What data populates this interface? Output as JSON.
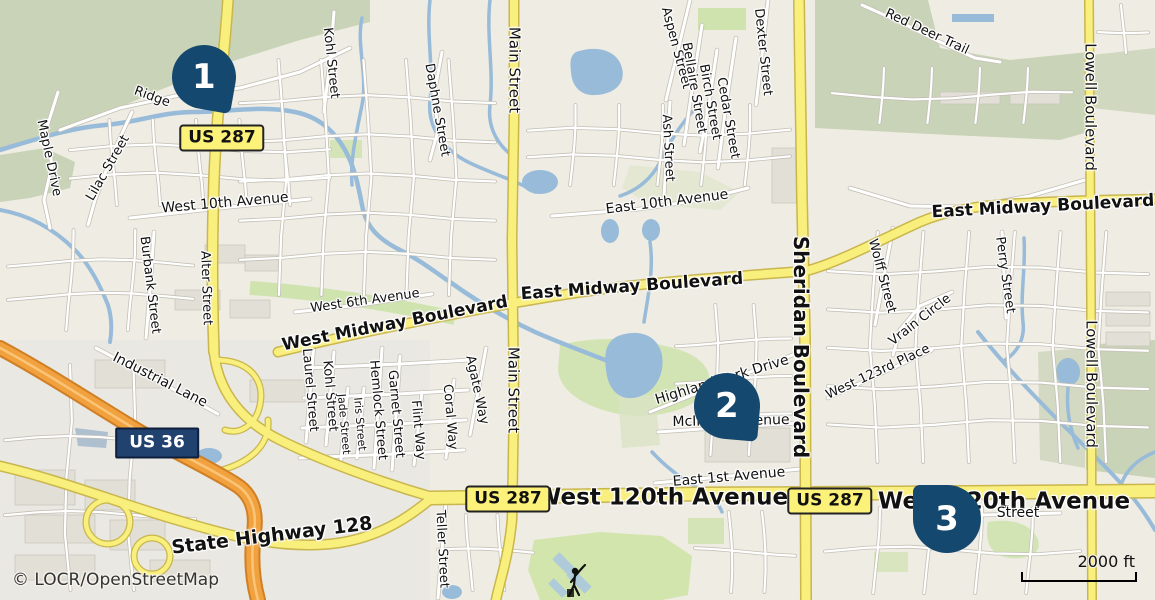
{
  "map": {
    "attribution": "© LOCR/OpenStreetMap",
    "scale": {
      "label": "2000 ft"
    }
  },
  "colors": {
    "land": "#efece3",
    "scrub_green": "#c9d3b7",
    "park_green": "#cfe3ae",
    "water": "#97bbd9",
    "road_major_fill": "#f9ef7d",
    "road_major_casing": "#c9b64d",
    "motorway_fill": "#f2a13f",
    "motorway_casing": "#cf7f24",
    "marker": "#15486e",
    "shield_yellow_bg": "#fdf279",
    "shield_navy_bg": "#21416f"
  },
  "markers": [
    {
      "number": "1",
      "x": 204,
      "y": 77,
      "size": 64,
      "tail": "br",
      "rot": 10
    },
    {
      "number": "2",
      "x": 727,
      "y": 406,
      "size": 66,
      "tail": "br",
      "rot": 5
    },
    {
      "number": "3",
      "x": 947,
      "y": 519,
      "size": 68,
      "tail": "tl",
      "rot": 0
    }
  ],
  "shields": [
    {
      "id": "us287-north",
      "label": "US 287",
      "style": "yellow",
      "x": 222,
      "y": 138
    },
    {
      "id": "us36",
      "label": "US 36",
      "style": "navy",
      "x": 157,
      "y": 443
    },
    {
      "id": "us287-west",
      "label": "US 287",
      "style": "yellow",
      "x": 508,
      "y": 499
    },
    {
      "id": "us287-east",
      "label": "US 287",
      "style": "yellow",
      "x": 830,
      "y": 501
    }
  ],
  "labels": [
    {
      "text": "Ridge",
      "x": 152,
      "y": 97,
      "rot": 20,
      "size": 13,
      "bold": false
    },
    {
      "text": "Maple Drive",
      "x": 49,
      "y": 158,
      "rot": 78,
      "size": 13,
      "bold": false
    },
    {
      "text": "Lilac Street",
      "x": 108,
      "y": 168,
      "rot": -60,
      "size": 13,
      "bold": false
    },
    {
      "text": "Kohl Street",
      "x": 331,
      "y": 63,
      "rot": 84,
      "size": 13,
      "bold": false
    },
    {
      "text": "Daphne Street",
      "x": 437,
      "y": 110,
      "rot": 80,
      "size": 13,
      "bold": false
    },
    {
      "text": "Main Street",
      "x": 514,
      "y": 70,
      "rot": 90,
      "size": 15,
      "bold": false
    },
    {
      "text": "Aspen Street",
      "x": 676,
      "y": 48,
      "rot": 75,
      "size": 13,
      "bold": false
    },
    {
      "text": "Bellaire Street",
      "x": 694,
      "y": 88,
      "rot": 80,
      "size": 13,
      "bold": false
    },
    {
      "text": "Birch Street",
      "x": 710,
      "y": 102,
      "rot": 80,
      "size": 13,
      "bold": false
    },
    {
      "text": "Cedar Street",
      "x": 728,
      "y": 118,
      "rot": 80,
      "size": 13,
      "bold": false
    },
    {
      "text": "Dexter Street",
      "x": 763,
      "y": 52,
      "rot": 84,
      "size": 13,
      "bold": false
    },
    {
      "text": "Ash Street",
      "x": 668,
      "y": 148,
      "rot": 87,
      "size": 13,
      "bold": false
    },
    {
      "text": "Red Deer Trail",
      "x": 927,
      "y": 32,
      "rot": 25,
      "size": 13,
      "bold": false
    },
    {
      "text": "Lowell Boulevard",
      "x": 1090,
      "y": 107,
      "rot": 90,
      "size": 15,
      "bold": false
    },
    {
      "text": "West 10th Avenue",
      "x": 225,
      "y": 203,
      "rot": -5,
      "size": 14,
      "bold": false
    },
    {
      "text": "East 10th Avenue",
      "x": 667,
      "y": 202,
      "rot": -7,
      "size": 14,
      "bold": false
    },
    {
      "text": "East Midway Boulevard",
      "x": 1043,
      "y": 207,
      "rot": -3,
      "size": 17,
      "bold": true
    },
    {
      "text": "Perry Street",
      "x": 1005,
      "y": 275,
      "rot": 82,
      "size": 13,
      "bold": false
    },
    {
      "text": "Burbank Street",
      "x": 150,
      "y": 285,
      "rot": 83,
      "size": 13,
      "bold": false
    },
    {
      "text": "Alter Street",
      "x": 206,
      "y": 288,
      "rot": 88,
      "size": 13,
      "bold": false
    },
    {
      "text": "West 6th Avenue",
      "x": 365,
      "y": 301,
      "rot": -8,
      "size": 13,
      "bold": false
    },
    {
      "text": "West Midway Boulevard",
      "x": 395,
      "y": 324,
      "rot": -11,
      "size": 17,
      "bold": true
    },
    {
      "text": "East Midway Boulevard",
      "x": 632,
      "y": 287,
      "rot": -4,
      "size": 17,
      "bold": true
    },
    {
      "text": "Sheridan Boulevard",
      "x": 801,
      "y": 347,
      "rot": 90,
      "size": 20,
      "bold": true
    },
    {
      "text": "Wolff Street",
      "x": 882,
      "y": 276,
      "rot": 75,
      "size": 13,
      "bold": false
    },
    {
      "text": "Vrain Circle",
      "x": 920,
      "y": 320,
      "rot": -38,
      "size": 13,
      "bold": false
    },
    {
      "text": "West 123rd Place",
      "x": 878,
      "y": 372,
      "rot": -25,
      "size": 13,
      "bold": false
    },
    {
      "text": "Lowell Boulevard",
      "x": 1091,
      "y": 384,
      "rot": 90,
      "size": 15,
      "bold": false
    },
    {
      "text": "Industrial Lane",
      "x": 160,
      "y": 380,
      "rot": 27,
      "size": 14,
      "bold": false
    },
    {
      "text": "Laurel Street",
      "x": 310,
      "y": 390,
      "rot": 85,
      "size": 13,
      "bold": false
    },
    {
      "text": "Kohl Street",
      "x": 330,
      "y": 396,
      "rot": 85,
      "size": 13,
      "bold": false
    },
    {
      "text": "Jade Street",
      "x": 344,
      "y": 424,
      "rot": 85,
      "size": 11,
      "bold": false
    },
    {
      "text": "Iris Street",
      "x": 360,
      "y": 424,
      "rot": 85,
      "size": 11,
      "bold": false
    },
    {
      "text": "Hemlock Street",
      "x": 378,
      "y": 410,
      "rot": 85,
      "size": 13,
      "bold": false
    },
    {
      "text": "Garnet Street",
      "x": 396,
      "y": 414,
      "rot": 85,
      "size": 13,
      "bold": false
    },
    {
      "text": "Flint Way",
      "x": 418,
      "y": 430,
      "rot": 85,
      "size": 13,
      "bold": false
    },
    {
      "text": "Coral Way",
      "x": 450,
      "y": 417,
      "rot": 85,
      "size": 13,
      "bold": false
    },
    {
      "text": "Agate Way",
      "x": 477,
      "y": 390,
      "rot": 78,
      "size": 13,
      "bold": false
    },
    {
      "text": "Main Street",
      "x": 513,
      "y": 390,
      "rot": 90,
      "size": 15,
      "bold": false
    },
    {
      "text": "Highland Park Drive",
      "x": 722,
      "y": 380,
      "rot": -17,
      "size": 14,
      "bold": false
    },
    {
      "text": "McIntyre Avenue",
      "x": 731,
      "y": 421,
      "rot": -1,
      "size": 14,
      "bold": false
    },
    {
      "text": "East 1st Avenue",
      "x": 729,
      "y": 477,
      "rot": -5,
      "size": 14,
      "bold": false
    },
    {
      "text": "West 120th Avenue",
      "x": 662,
      "y": 498,
      "rot": 0,
      "size": 23,
      "bold": true
    },
    {
      "text": "West 120th Avenue",
      "x": 1004,
      "y": 502,
      "rot": 0,
      "size": 23,
      "bold": true
    },
    {
      "text": "Street",
      "x": 1018,
      "y": 513,
      "rot": 0,
      "size": 14,
      "bold": false
    },
    {
      "text": "State Highway 128",
      "x": 272,
      "y": 536,
      "rot": -7,
      "size": 19,
      "bold": true
    },
    {
      "text": "Teller Street",
      "x": 442,
      "y": 549,
      "rot": 87,
      "size": 13,
      "bold": false
    }
  ]
}
